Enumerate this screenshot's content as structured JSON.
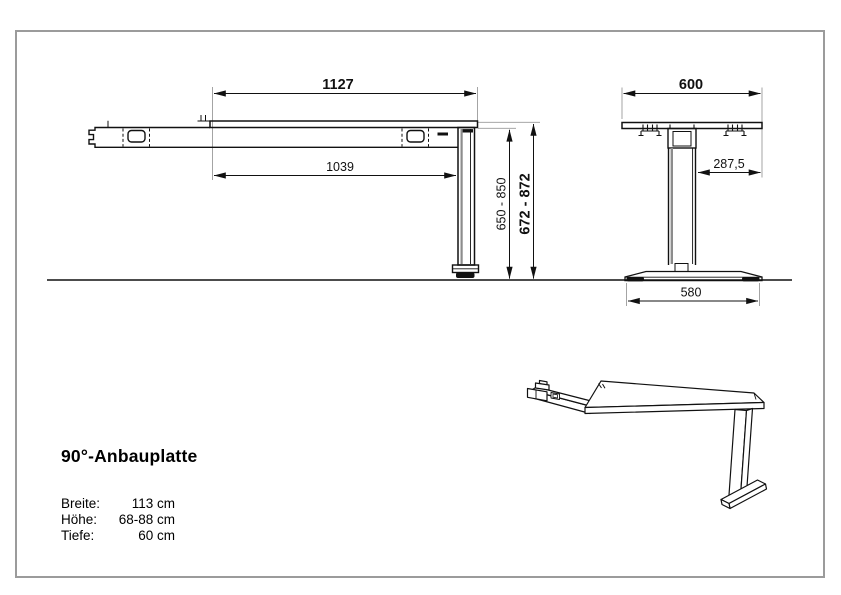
{
  "style": {
    "background": "#ffffff",
    "frame_border": "#9b9b9b",
    "line_color": "#111111",
    "extension_line_color": "#9a9a9a",
    "accent_gray": "#8c8c8c"
  },
  "side_view": {
    "dim_top_width": "1127",
    "dim_arm_length": "1039",
    "dim_leg_height": "650 - 850",
    "dim_total_height": "672 - 872"
  },
  "front_view": {
    "dim_top_depth": "600",
    "dim_column_to_edge": "287,5",
    "dim_base_width": "580"
  },
  "product": {
    "title": "90°-Anbauplatte",
    "specs": [
      {
        "label": "Breite:",
        "value": "113 cm"
      },
      {
        "label": "Höhe:",
        "value": "68-88 cm"
      },
      {
        "label": "Tiefe:",
        "value": "60 cm"
      }
    ]
  }
}
